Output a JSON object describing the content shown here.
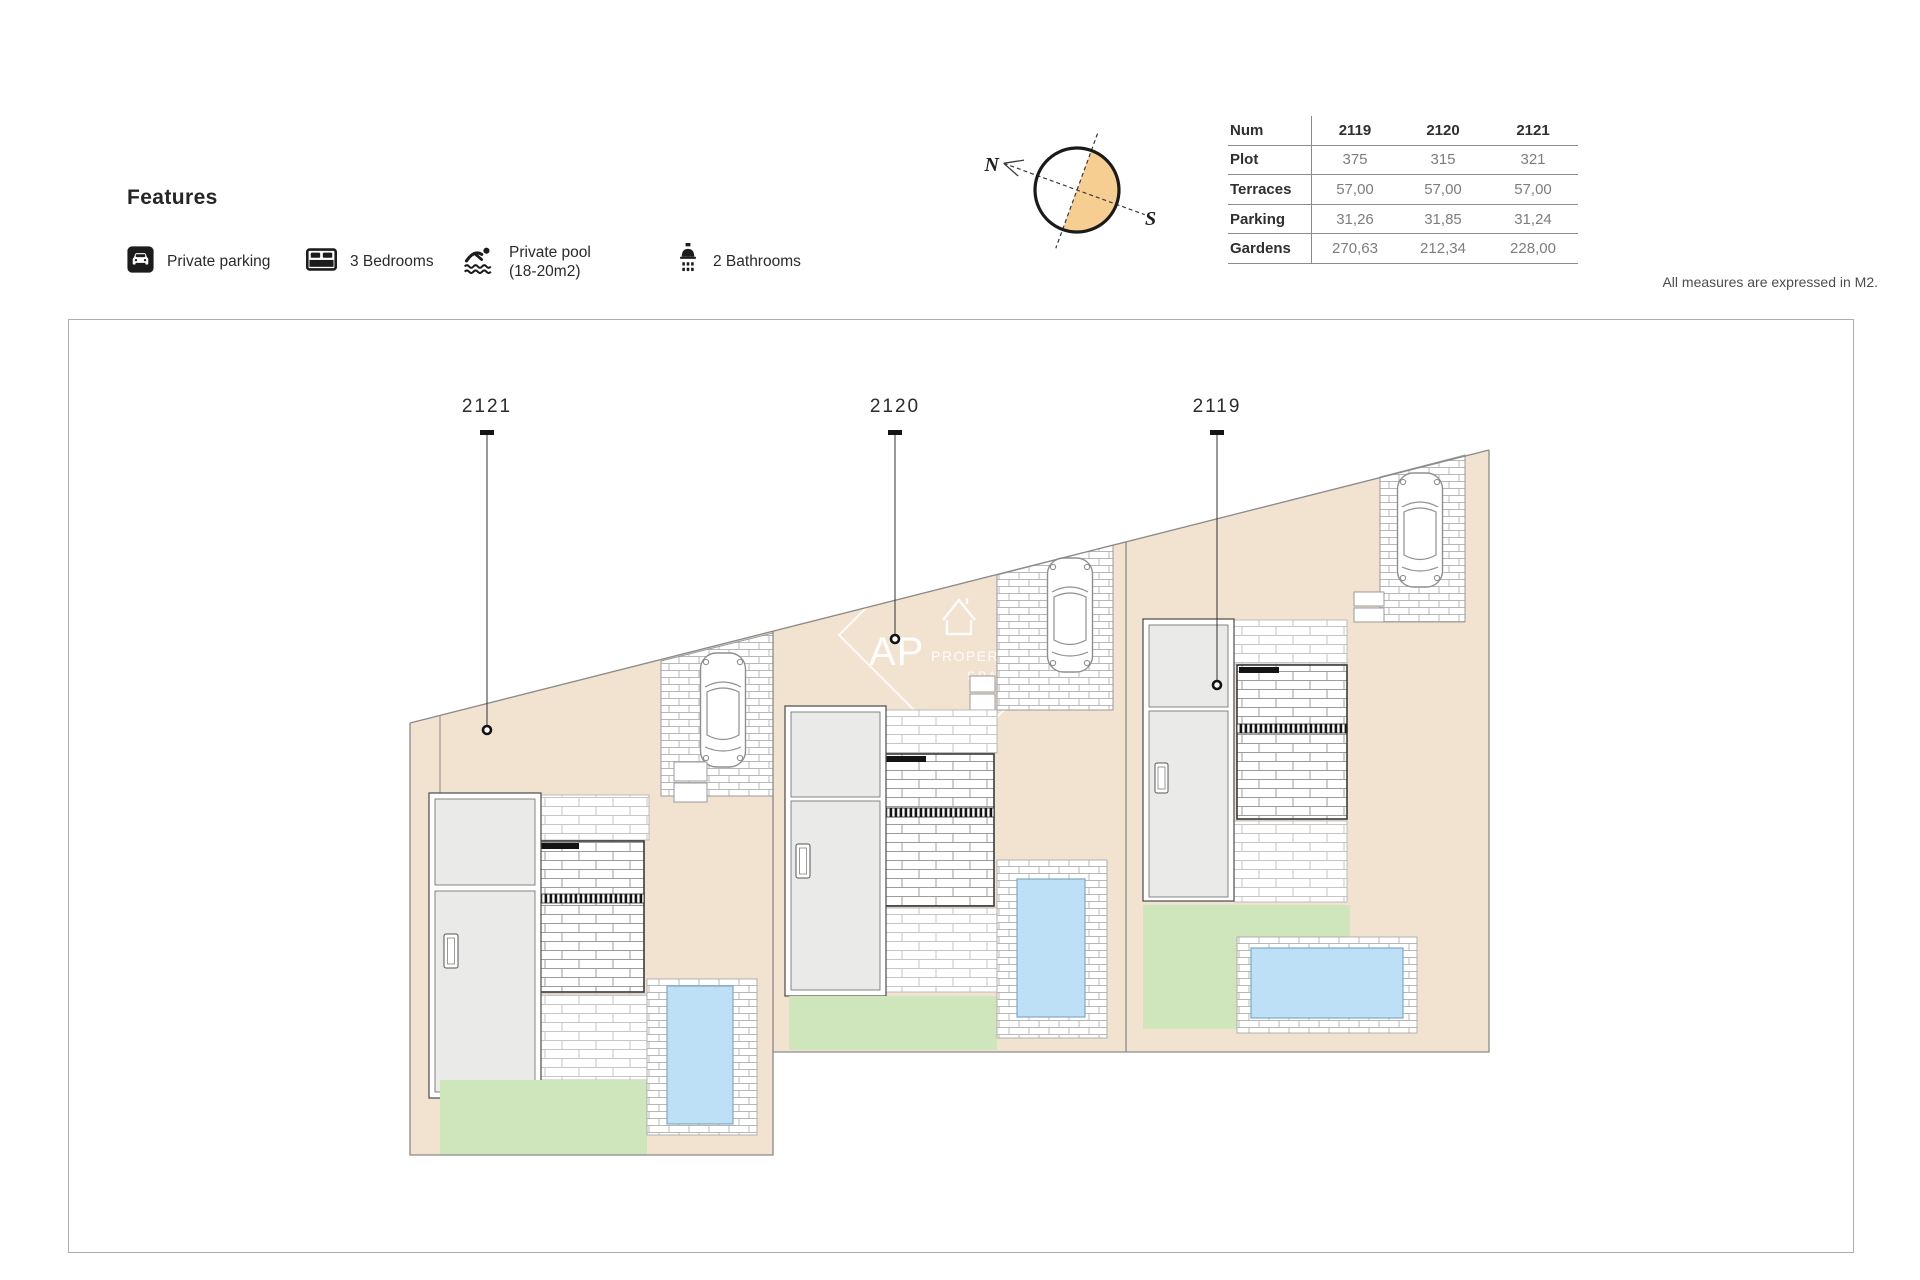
{
  "features": {
    "title": "Features",
    "items": [
      {
        "icon": "parking-icon",
        "label": "Private parking"
      },
      {
        "icon": "bed-icon",
        "label": "3 Bedrooms"
      },
      {
        "icon": "pool-icon",
        "label": "Private pool",
        "label2": "(18-20m2)"
      },
      {
        "icon": "shower-icon",
        "label": "2 Bathrooms"
      }
    ]
  },
  "compass": {
    "north_label": "N",
    "south_label": "S",
    "fill_color": "#F6CE92"
  },
  "table": {
    "header_label": "Num",
    "columns": [
      "2119",
      "2120",
      "2121"
    ],
    "rows": [
      {
        "label": "Plot",
        "values": [
          "375",
          "315",
          "321"
        ]
      },
      {
        "label": "Terraces",
        "values": [
          "57,00",
          "57,00",
          "57,00"
        ]
      },
      {
        "label": "Parking",
        "values": [
          "31,26",
          "31,85",
          "31,24"
        ]
      },
      {
        "label": "Gardens",
        "values": [
          "270,63",
          "212,34",
          "228,00"
        ]
      }
    ]
  },
  "note": "All measures are expressed in M2.",
  "plan": {
    "labels": [
      "2121",
      "2120",
      "2119"
    ],
    "watermark": {
      "line1": "AP",
      "line2": "PROPERTIES",
      "line3": "SPAIN"
    },
    "colors": {
      "ground": "#F2E2D0",
      "garden": "#CFE5BC",
      "pool": "#BDE0F6",
      "building": "#EAEAE8"
    }
  }
}
